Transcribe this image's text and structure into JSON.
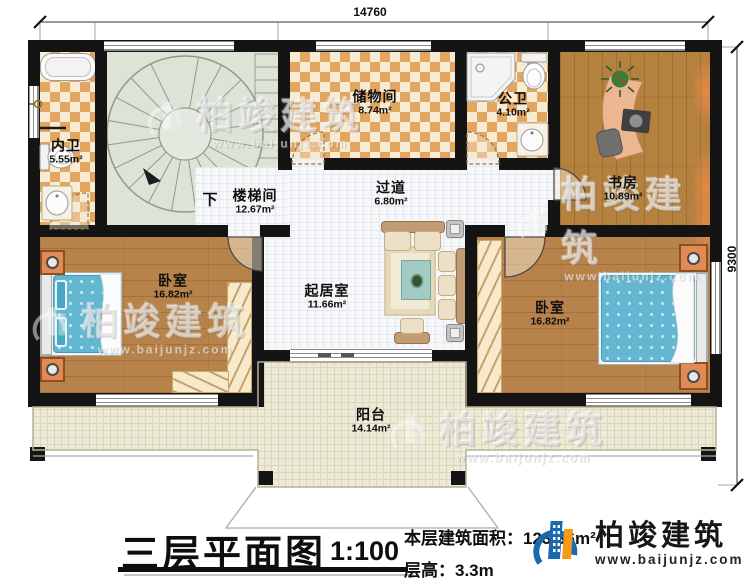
{
  "dimensions": {
    "width_top": "14760",
    "height_right": "9300"
  },
  "rooms": [
    {
      "name": "内卫",
      "area": "5.55m²"
    },
    {
      "name": "楼梯间",
      "area": "12.67m²",
      "direction": "下"
    },
    {
      "name": "储物间",
      "area": "8.74m²"
    },
    {
      "name": "公卫",
      "area": "4.10m²"
    },
    {
      "name": "书房",
      "area": "10.89m²"
    },
    {
      "name": "过道",
      "area": "6.80m²"
    },
    {
      "name": "卧室",
      "area": "16.82m²"
    },
    {
      "name": "起居室",
      "area": "11.66m²"
    },
    {
      "name": "卧室",
      "area": "16.82m²"
    },
    {
      "name": "阳台",
      "area": "14.14m²"
    }
  ],
  "title_block": {
    "title": "三层平面图",
    "scale": "1:100",
    "floor_area": "本层建筑面积：123.36m²",
    "floor_height": "层高：3.3m"
  },
  "brand": {
    "name": "柏竣建筑",
    "website": "www.baijunjz.com"
  },
  "watermark": {
    "name": "柏竣建筑",
    "website": "www.baijunjz.com"
  },
  "colors": {
    "wall": "#141414",
    "tile_accent": "#e3a660",
    "wood": "#b8834a",
    "bed": "#64b7d0",
    "brand_blue": "#1a69ae",
    "brand_orange": "#f49c17"
  },
  "fixtures": [
    "bathtub",
    "toilet",
    "sink",
    "shower",
    "spiral-staircase",
    "bed",
    "nightstand",
    "wardrobe",
    "sofa",
    "coffee-table",
    "rug",
    "side-table",
    "desk",
    "office-chair",
    "monitor",
    "plant",
    "curtain",
    "sliding-door",
    "door",
    "pillar"
  ]
}
